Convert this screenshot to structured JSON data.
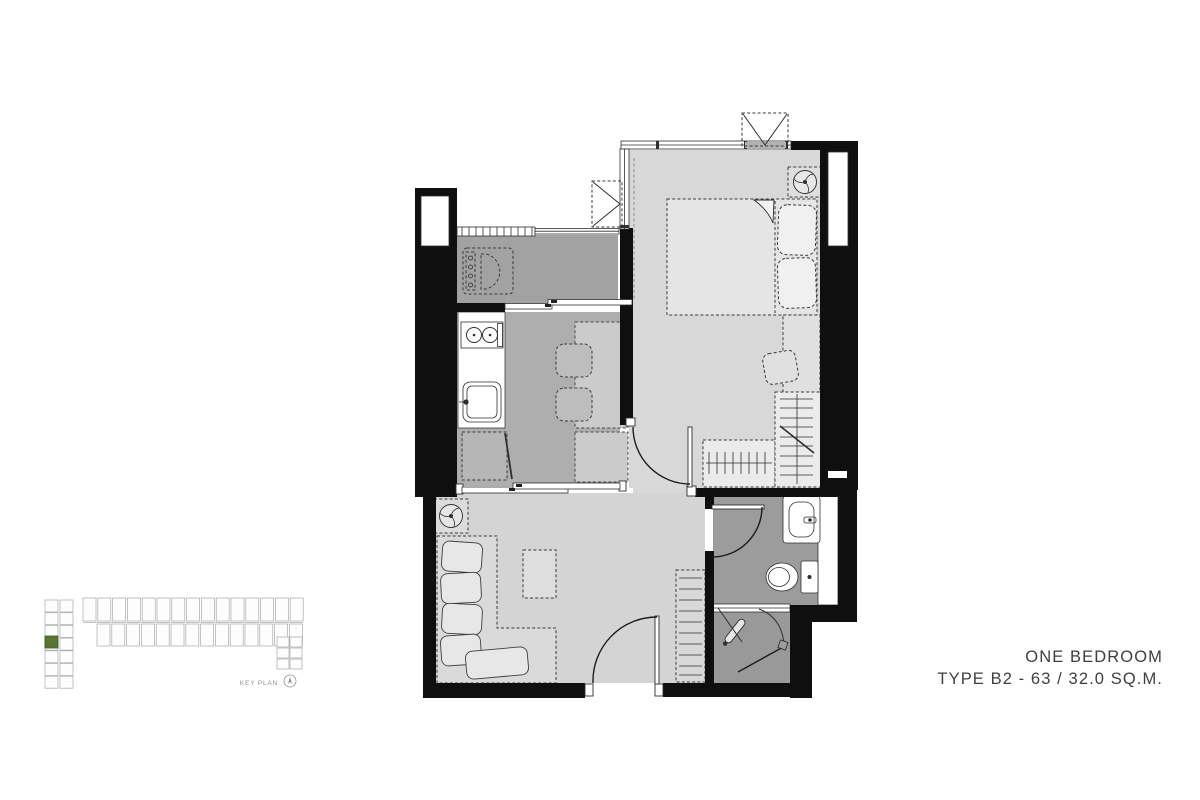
{
  "title": {
    "line1": "ONE BEDROOM",
    "line2": "TYPE B2 - 63 / 32.0 SQ.M."
  },
  "key_plan": {
    "label": "KEY PLAN",
    "highlighted_unit_color": "#5a7434"
  },
  "palette": {
    "wall": "#0f0f0f",
    "bedroom_floor": "#d8d8d8",
    "living_floor": "#d4d4d4",
    "dining_floor": "#aeaeae",
    "balcony_floor": "#a2a2a2",
    "bathroom_floor": "#9c9c9c",
    "shower_floor": "#999999",
    "fixture_white": "#ffffff",
    "text": "#3f3f3f"
  },
  "symbols": [
    "bed",
    "pillows",
    "blanket-fold",
    "wardrobe-hangers",
    "dressing-stool",
    "desk",
    "fan-coil-unit",
    "ac-condenser",
    "washing-machine",
    "stove",
    "kitchen-sink",
    "kitchen-counter",
    "floor-mat",
    "dining-table",
    "dining-chairs",
    "sofa",
    "coffee-table",
    "hall-cabinet",
    "wash-basin",
    "toilet",
    "shower",
    "sliding-door",
    "swing-door",
    "window",
    "balcony-railing",
    "north-arrow"
  ]
}
